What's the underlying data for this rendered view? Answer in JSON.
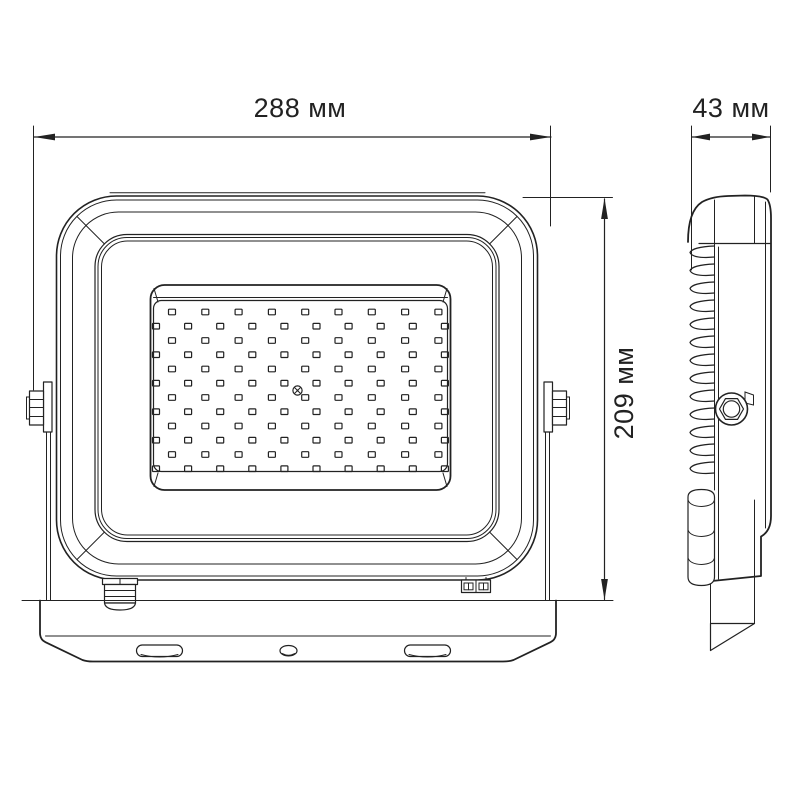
{
  "page": {
    "background": "#ffffff",
    "line_color": "#222222",
    "description": "LED floodlight technical dimension drawing, front and side views"
  },
  "dimensions": {
    "width": {
      "value": "288",
      "unit": "мм",
      "label": "288 мм"
    },
    "height": {
      "value": "209",
      "unit": "мм",
      "label": "209 мм"
    },
    "depth": {
      "value": "43",
      "unit": "мм",
      "label": "43 мм"
    }
  },
  "led_grid": {
    "rows": 12,
    "row_y0": 312,
    "row_dy": 14.25,
    "row_a": {
      "count": 9,
      "x0": 172,
      "dx": 33.3
    },
    "row_b": {
      "count": 10,
      "x0": 156,
      "dx": 32.1
    },
    "led_width": 7,
    "led_height": 5.6
  },
  "heatsink": {
    "fin_count": 13,
    "fin_y0": 246,
    "fin_dy": 18
  }
}
